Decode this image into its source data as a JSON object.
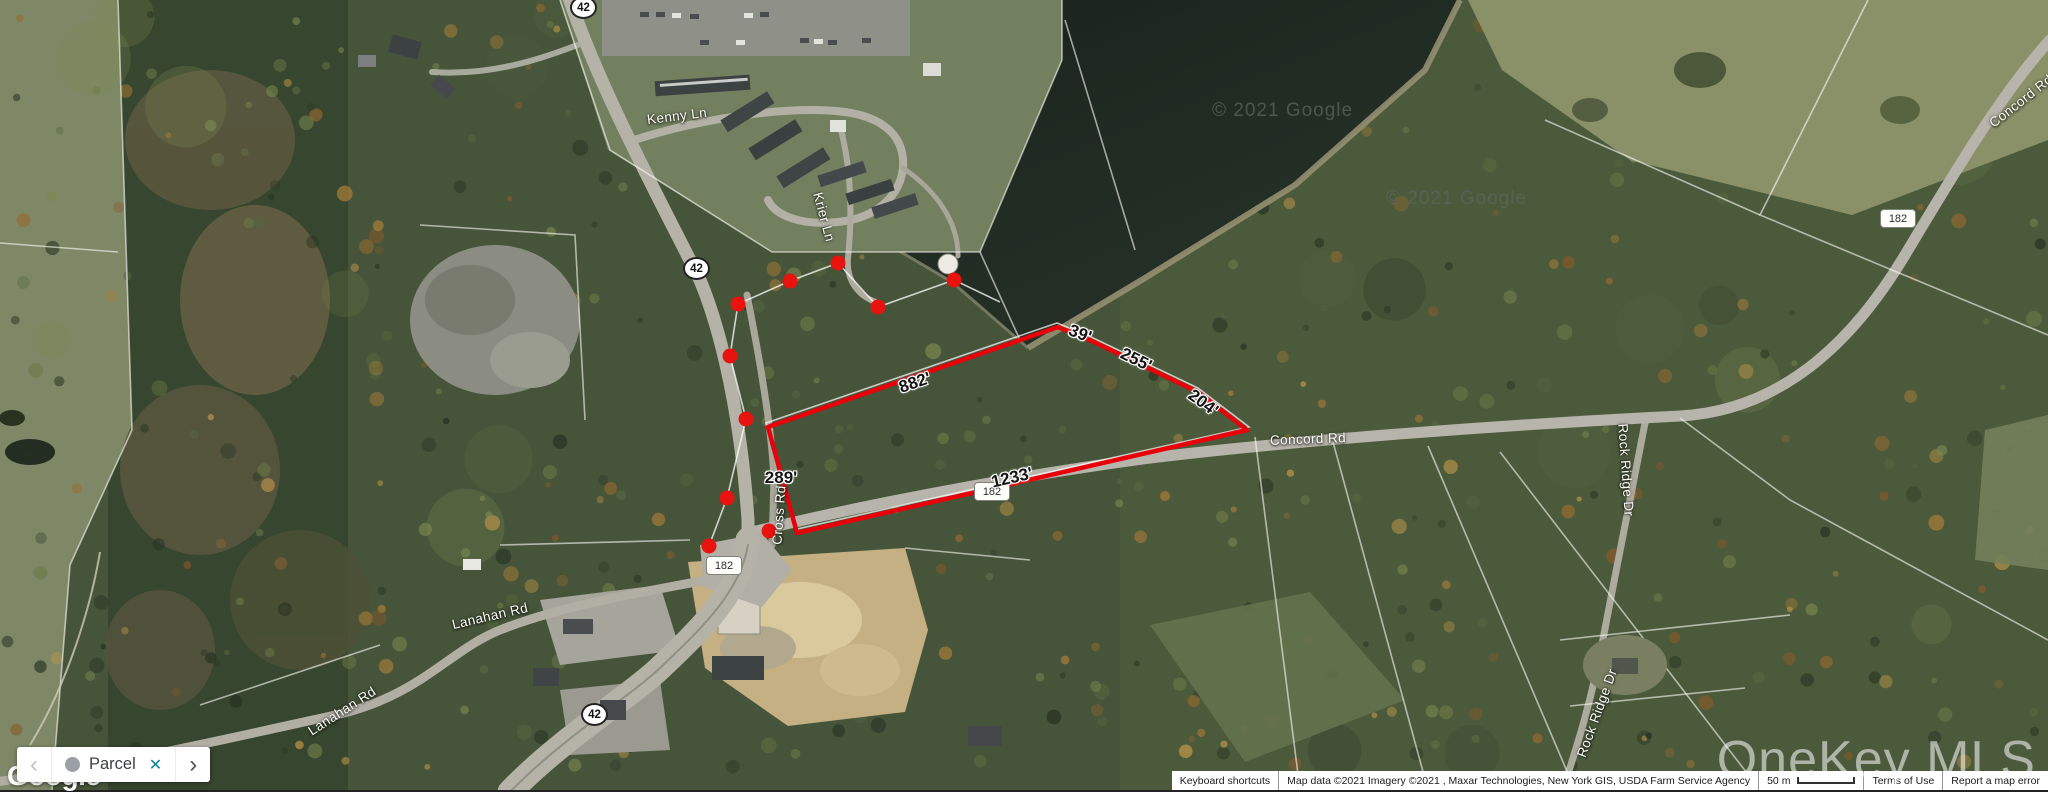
{
  "chip": {
    "prev_label": "‹",
    "label": "Parcel",
    "close_label": "✕",
    "next_label": "›"
  },
  "logo_text": "Google",
  "mls_watermark": "OneKey MLS",
  "lake_watermarks": [
    {
      "text": "© 2021 Google"
    },
    {
      "text": "© 2021 Google"
    }
  ],
  "parcel": {
    "outline_color": "#e8000b",
    "measurements": [
      {
        "text": "882'"
      },
      {
        "text": "39'"
      },
      {
        "text": "255'"
      },
      {
        "text": "204'"
      },
      {
        "text": "1233'"
      },
      {
        "text": "289'"
      }
    ]
  },
  "roads": {
    "labels": [
      {
        "text": "Kenny Ln"
      },
      {
        "text": "Krier Ln"
      },
      {
        "text": "Concord Rd"
      },
      {
        "text": "Concord Rd"
      },
      {
        "text": "Cross Rd"
      },
      {
        "text": "Lanahan Rd"
      },
      {
        "text": "Lanahan Rd"
      },
      {
        "text": "Rock Ridge Dr"
      },
      {
        "text": "Rock Ridge Dr"
      }
    ],
    "shields": [
      {
        "text": "42"
      },
      {
        "text": "42"
      },
      {
        "text": "42"
      },
      {
        "text": "182"
      },
      {
        "text": "182"
      },
      {
        "text": "182"
      }
    ]
  },
  "attribution": {
    "keyboard_shortcuts": "Keyboard shortcuts",
    "map_data": "Map data ©2021 Imagery ©2021 , Maxar Technologies, New York GIS, USDA Farm Service Agency",
    "scale_label": "50 m",
    "terms": "Terms of Use",
    "report": "Report a map error"
  },
  "colors": {
    "parcel_red": "#e8000b",
    "chip_close_teal": "#0c7f9e",
    "lake": "#1e2921",
    "forest_base": "#46543a"
  }
}
